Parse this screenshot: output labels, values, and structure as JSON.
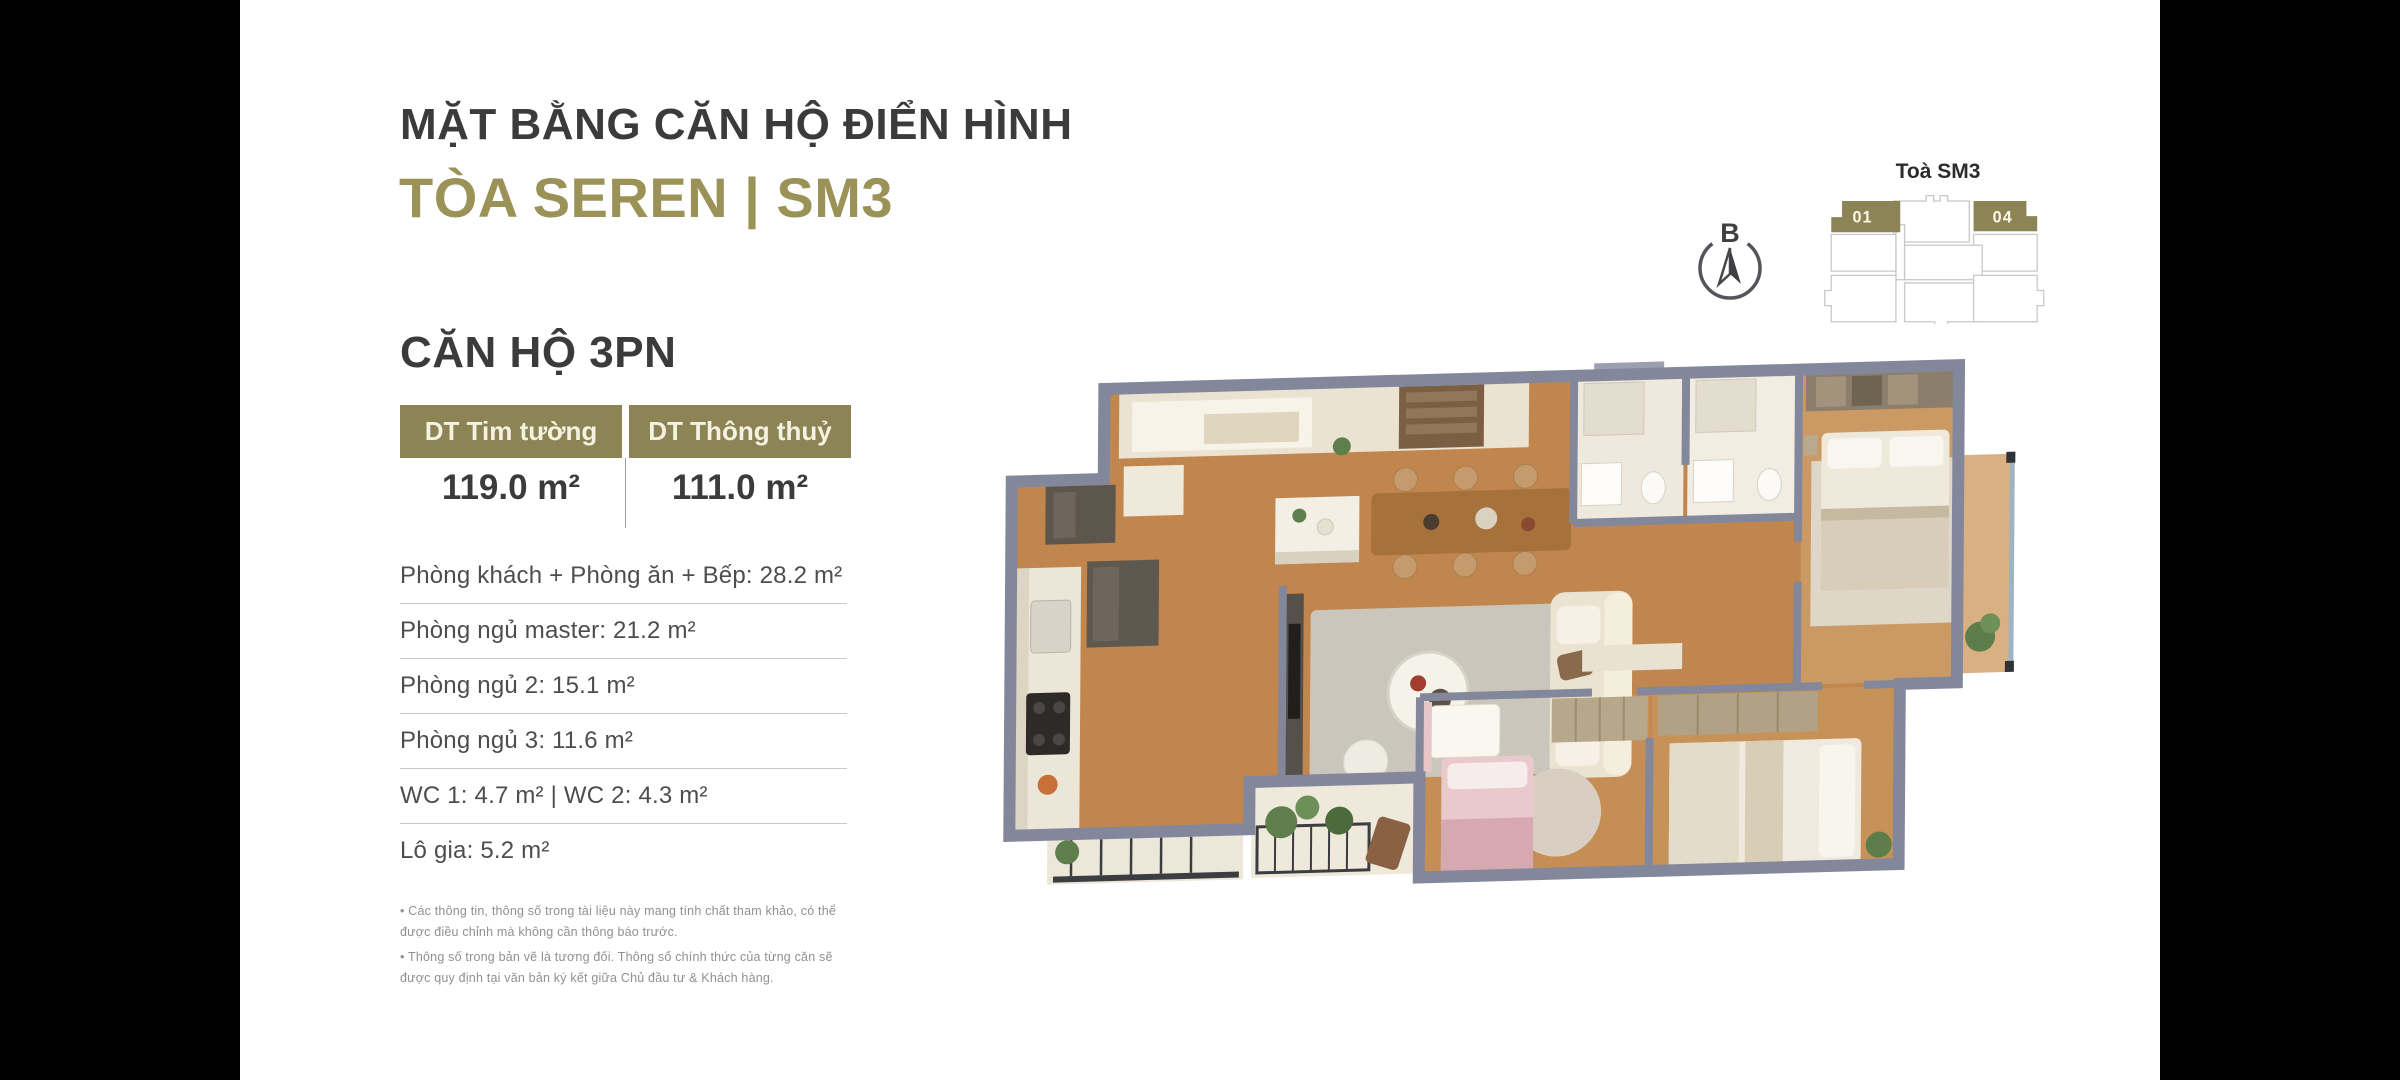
{
  "colors": {
    "accent_olive": "#9a9256",
    "table_header_olive": "#8c8455",
    "title_dark": "#3b3b3b"
  },
  "header": {
    "title": "MẶT BẰNG CĂN HỘ ĐIỂN HÌNH",
    "subtitle": "TÒA SEREN | SM3"
  },
  "apartment": {
    "name": "CĂN HỘ 3PN",
    "table": {
      "col1_label": "DT Tim tường",
      "col1_value": "119.0 m²",
      "col2_label": "DT Thông thuỷ",
      "col2_value": "111.0 m²"
    },
    "rooms": [
      "Phòng khách + Phòng ăn + Bếp: 28.2 m²",
      "Phòng ngủ master: 21.2 m²",
      "Phòng ngủ 2: 15.1 m²",
      "Phòng ngủ 3: 11.6 m²",
      "WC 1: 4.7 m² | WC 2: 4.3 m²",
      "Lô gia: 5.2 m²"
    ],
    "notes": [
      "• Các thông tin, thông số trong tài liệu này mang tính chất tham khảo, có thể được điều chỉnh mà không cần thông báo trước.",
      "• Thông số trong bản vẽ là tương đối. Thông số chính thức của từng căn sẽ được quy định tại văn bản ký kết giữa Chủ đầu tư & Khách hàng."
    ]
  },
  "tower": {
    "label": "Toà SM3",
    "units": [
      {
        "id": "01",
        "highlighted": true
      },
      {
        "id": "04",
        "highlighted": true
      }
    ]
  },
  "compass": {
    "label": "B"
  }
}
